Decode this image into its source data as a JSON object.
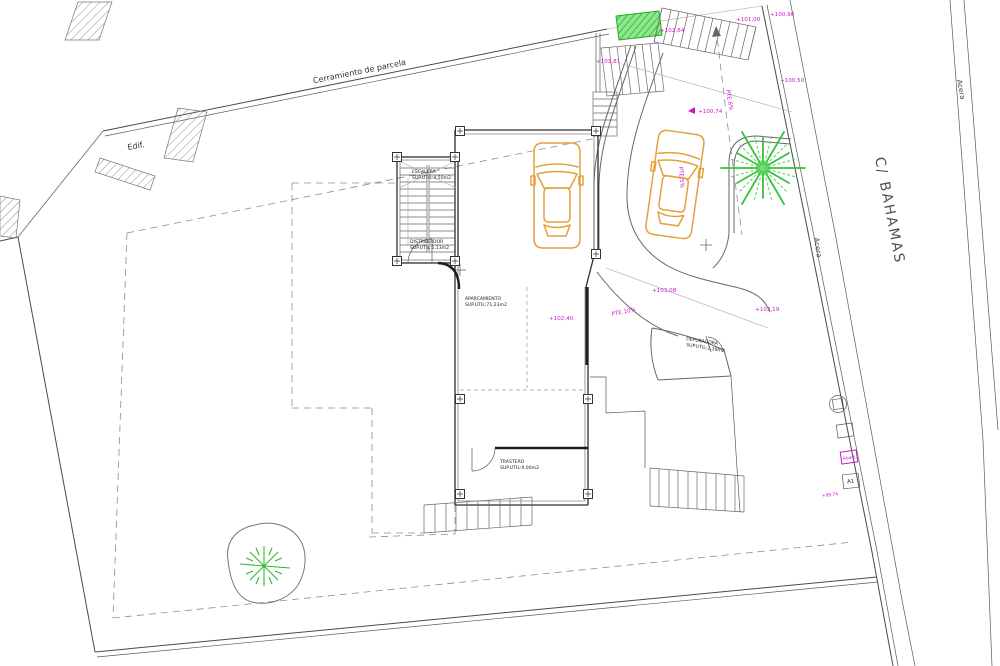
{
  "plan": {
    "fence": "Cerramiento de parcela",
    "adjacent": "Edif.",
    "street": "C/ BAHAMAS",
    "sidewalk1": "Acera",
    "sidewalk2": "Acera",
    "rooms": {
      "escalera_name": "ESCALERA",
      "escalera_area": "SUP.UTIL:4,50m2",
      "distribuidor_name": "DISTRIBUIDOR",
      "distribuidor_area": "SUP.UTIL:5,13m2",
      "aparcamiento_name": "APARCAMIENTO",
      "aparcamiento_area": "SUP.UTIL:71,23m2",
      "trastero_name": "TRASTERO",
      "trastero_area": "SUP.UTIL:9,00m2",
      "depuradora_name": "DEPURADORA",
      "depuradora_area": "SUP.UTIL:2,19m2"
    },
    "levels": {
      "e101_00": "+101,00",
      "e100_90": "+100,90",
      "e102_84": "+102,84",
      "e103_81": "+103,81",
      "e100_50": "+100,50",
      "e100_74": "+100,74",
      "e102_40": "+102,40",
      "e103_08": "+103,08",
      "e103_19": "+103,19",
      "e99_74": "+99,74"
    },
    "slopes": {
      "pte6": "PTE.6%",
      "pte10": "PTE.10%",
      "pte5": "PTE.5%"
    },
    "markers": {
      "a1": "A1",
      "abast": "Abast."
    },
    "colors": {
      "accent_magenta": "#c819c8",
      "car_orange": "#e2a139",
      "vegetation_green": "#35c435",
      "line_dark": "#4a4a4a"
    }
  }
}
